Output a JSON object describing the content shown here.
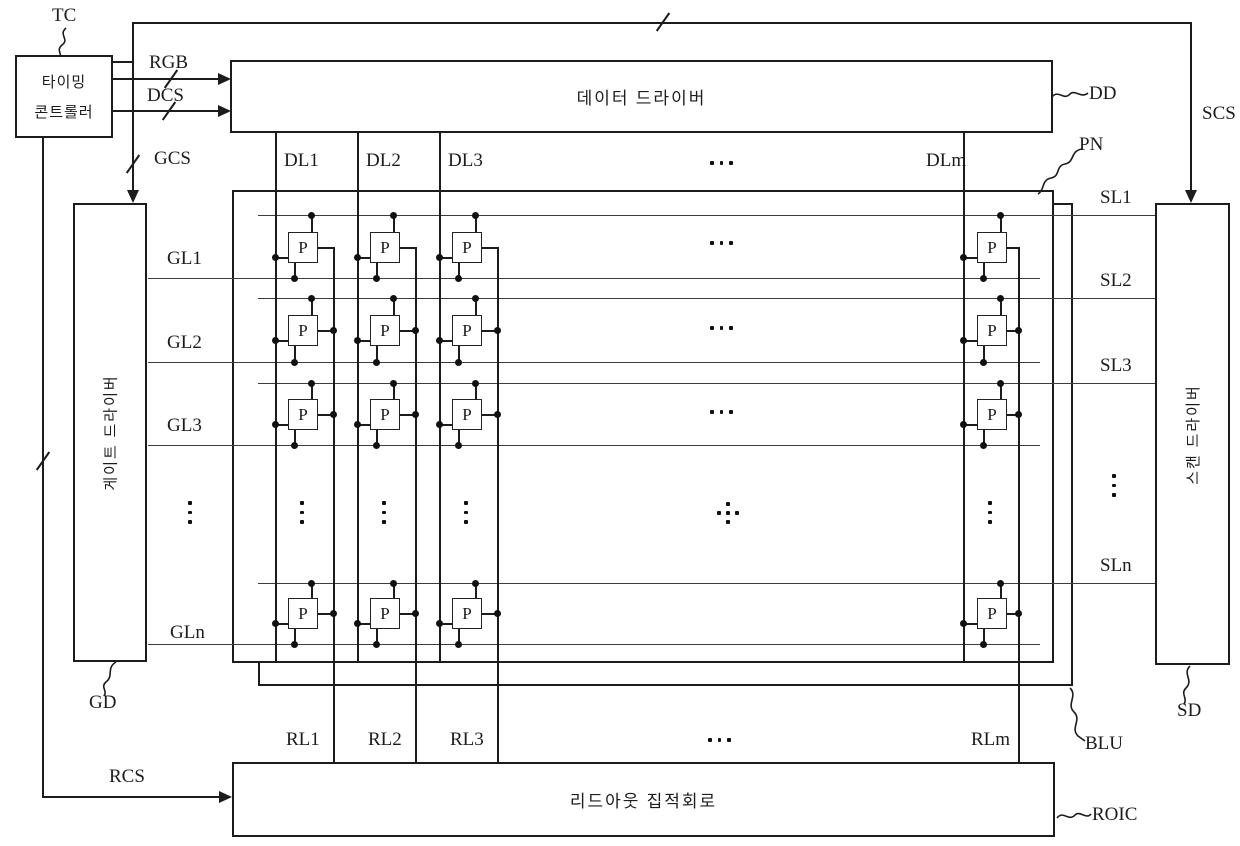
{
  "figure": {
    "blocks": {
      "timing_controller": {
        "name_line1": "타이밍",
        "name_line2": "콘트롤러",
        "ref": "TC"
      },
      "data_driver": {
        "name": "데이터 드라이버",
        "ref": "DD"
      },
      "gate_driver": {
        "name": "게이트 드라이버",
        "ref": "GD"
      },
      "scan_driver": {
        "name": "스캔 드라이버",
        "ref": "SD"
      },
      "readout_ic": {
        "name": "리드아웃 집적회로",
        "ref": "ROIC"
      },
      "panel": {
        "ref": "PN"
      },
      "backlight_unit": {
        "ref": "BLU"
      }
    },
    "signals": {
      "rgb": "RGB",
      "dcs": "DCS",
      "gcs": "GCS",
      "scs": "SCS",
      "rcs": "RCS"
    },
    "lines": {
      "data": [
        "DL1",
        "DL2",
        "DL3",
        "DLm"
      ],
      "gate": [
        "GL1",
        "GL2",
        "GL3",
        "GLn"
      ],
      "sense": [
        "SL1",
        "SL2",
        "SL3",
        "SLn"
      ],
      "readout": [
        "RL1",
        "RL2",
        "RL3",
        "RLm"
      ]
    },
    "pixel_label": "P",
    "colors": {
      "line": "#1c1c1c",
      "background": "#ffffff"
    }
  }
}
